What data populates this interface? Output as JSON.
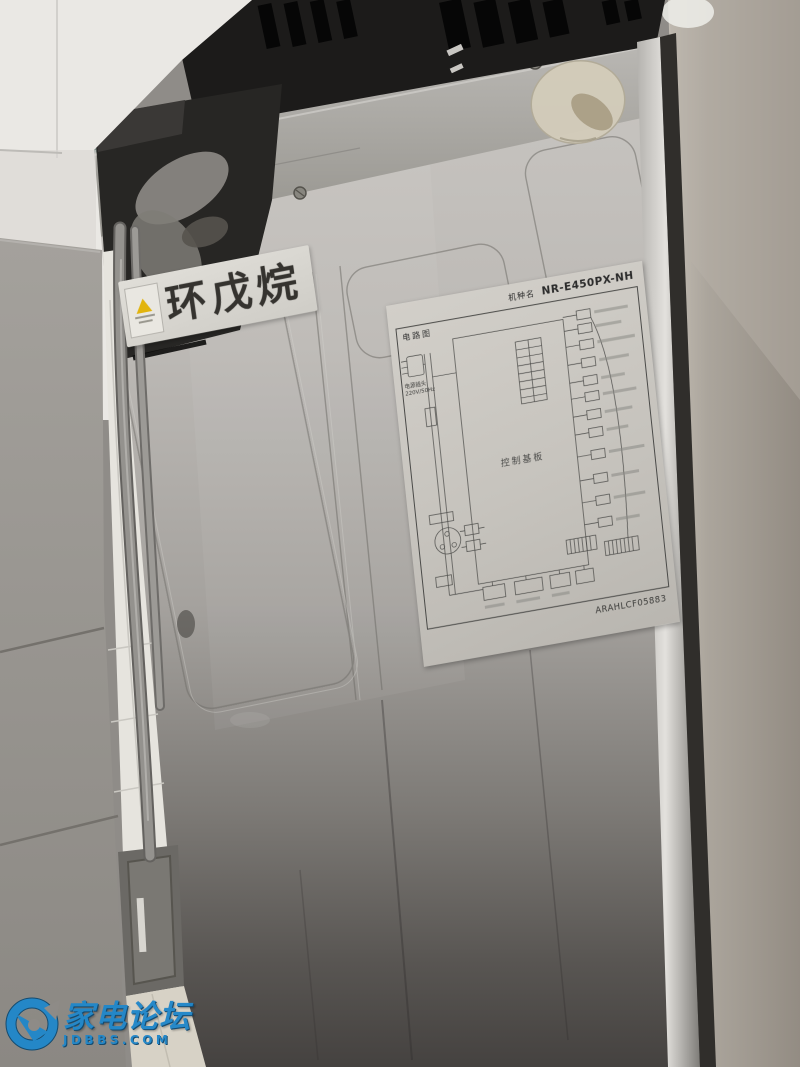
{
  "scene": {
    "cyclopentane_sticker": {
      "text": "环戊烷"
    },
    "wiring_diagram_label": {
      "side_title": "电路图",
      "model_name_label": "机种名",
      "model_number": "NR-E450PX-NH",
      "control_board_text": "控制基板",
      "power_plug_text": "电源插头",
      "power_rating_text": "220V/50Hz",
      "part_code": "ARAHLCF05883"
    },
    "watermark": {
      "site_name": "家电论坛",
      "site_domain": "JDBBS.COM"
    }
  },
  "colors": {
    "fridge_back_light": "#c9c6c2",
    "fridge_back_dark": "#454240",
    "side_panel": "#a69f96",
    "top_grille_black": "#1c1b1a",
    "cabinet_gray": "#96938e",
    "wall_white": "#eae8e4",
    "floor_tile": "#d7d2c6",
    "label_paper": "#c9c6c0",
    "watermark_blue": "#2187ca",
    "warning_yellow": "#e2b40e"
  }
}
